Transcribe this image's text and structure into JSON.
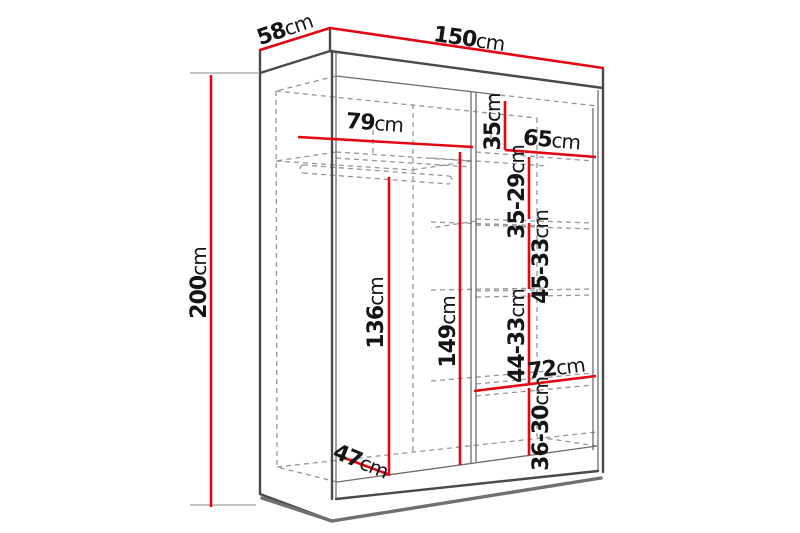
{
  "diagram": {
    "type": "furniture-dimension-diagram",
    "subject": "wardrobe perspective drawing with internal shelf dimensions",
    "units": "cm",
    "colors": {
      "dimension_line": "#e30613",
      "outline": "#4a4a4a",
      "hidden_line": "#969696",
      "text": "#151515",
      "background": "#ffffff"
    },
    "measurements": {
      "overall": {
        "width": "150cm",
        "depth": "58cm",
        "height": "200cm"
      },
      "top_shelf": {
        "left_width": "79cm",
        "right_width": "65cm",
        "top_right_cubby_height": "35cm"
      },
      "left_section": {
        "hanging_height": "136cm",
        "height_under_top_shelf": "149cm",
        "floor_depth": "47cm"
      },
      "right_section": {
        "shelf_width": "72cm",
        "shelf_gaps_top_to_bottom": [
          "35-29cm",
          "45-33cm",
          "44-33cm",
          "36-30cm"
        ]
      }
    },
    "labels": [
      {
        "id": "58cm",
        "num": "58",
        "unit": "cm",
        "x": 287,
        "y": 36,
        "rot": -19
      },
      {
        "id": "150cm",
        "num": "150",
        "unit": "cm",
        "x": 468,
        "y": 46,
        "rot": 8
      },
      {
        "id": "200cm",
        "num": "200",
        "unit": "cm",
        "x": 206,
        "y": 283,
        "rot": -90
      },
      {
        "id": "79cm",
        "num": "79",
        "unit": "cm",
        "x": 374,
        "y": 130,
        "rot": 4
      },
      {
        "id": "35cm",
        "num": "35",
        "unit": "cm",
        "x": 500,
        "y": 122,
        "rot": -90
      },
      {
        "id": "65cm",
        "num": "65",
        "unit": "cm",
        "x": 551,
        "y": 147,
        "rot": 5
      },
      {
        "id": "35-29cm",
        "num": "35-29",
        "unit": "cm",
        "x": 524,
        "y": 192,
        "rot": -90
      },
      {
        "id": "45-33cm",
        "num": "45-33",
        "unit": "cm",
        "x": 548,
        "y": 257,
        "rot": -90
      },
      {
        "id": "136cm",
        "num": "136",
        "unit": "cm",
        "x": 383,
        "y": 313,
        "rot": -90
      },
      {
        "id": "149cm",
        "num": "149",
        "unit": "cm",
        "x": 455,
        "y": 332,
        "rot": -90
      },
      {
        "id": "44-33cm",
        "num": "44-33",
        "unit": "cm",
        "x": 524,
        "y": 336,
        "rot": -90
      },
      {
        "id": "72cm",
        "num": "72",
        "unit": "cm",
        "x": 557,
        "y": 375,
        "rot": -7
      },
      {
        "id": "36-30cm",
        "num": "36-30",
        "unit": "cm",
        "x": 548,
        "y": 424,
        "rot": -90
      },
      {
        "id": "47cm",
        "num": "47",
        "unit": "cm",
        "x": 358,
        "y": 468,
        "rot": 22
      }
    ]
  }
}
